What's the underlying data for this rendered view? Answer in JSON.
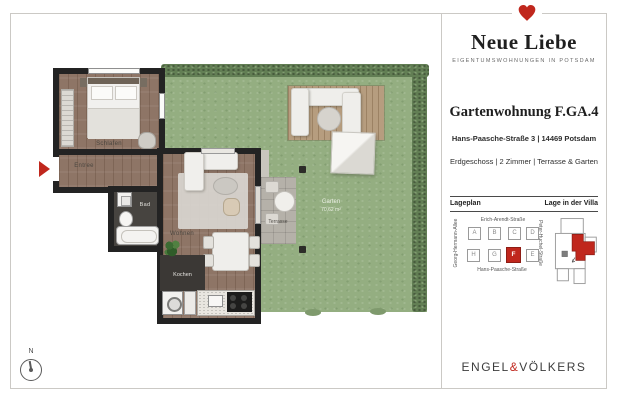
{
  "brand": {
    "title": "Neue Liebe",
    "subtitle": "EIGENTUMSWOHNUNGEN IN POTSDAM"
  },
  "unit": {
    "title": "Gartenwohnung F.GA.4",
    "address": "Hans-Paasche-Straße 3 | 14469 Potsdam",
    "details": "Erdgeschoss | 2 Zimmer | Terrasse & Garten"
  },
  "siteplan": {
    "heading_left": "Lageplan",
    "heading_right": "Lage in der Villa",
    "streets": {
      "top": "Erich-Arendt-Straße",
      "bottom": "Hans-Paasche-Straße",
      "left": "Georg-Hermann-Allee",
      "right": "Peter-Huchel-Straße"
    },
    "buildings": {
      "row1": [
        "A",
        "B",
        "C",
        "D"
      ],
      "row2": [
        "H",
        "G",
        "F",
        "E"
      ],
      "highlighted": "F"
    }
  },
  "floorplan": {
    "labels": {
      "bedroom": "Schlafen",
      "entry": "Entree",
      "bath": "Bad",
      "living": "Wohnen",
      "kitchen": "Kochen",
      "terrace": "Terrasse",
      "garden": "Garten",
      "garden_area": "70,62 m²"
    },
    "compass": "N"
  },
  "logo": {
    "part1": "ENGEL",
    "amp": "&",
    "part2": "VÖLKERS"
  },
  "colors": {
    "accent_red": "#c0271d",
    "grass_green": "#94ae81",
    "wood_brown": "#8e7566",
    "wall_black": "#232323"
  }
}
